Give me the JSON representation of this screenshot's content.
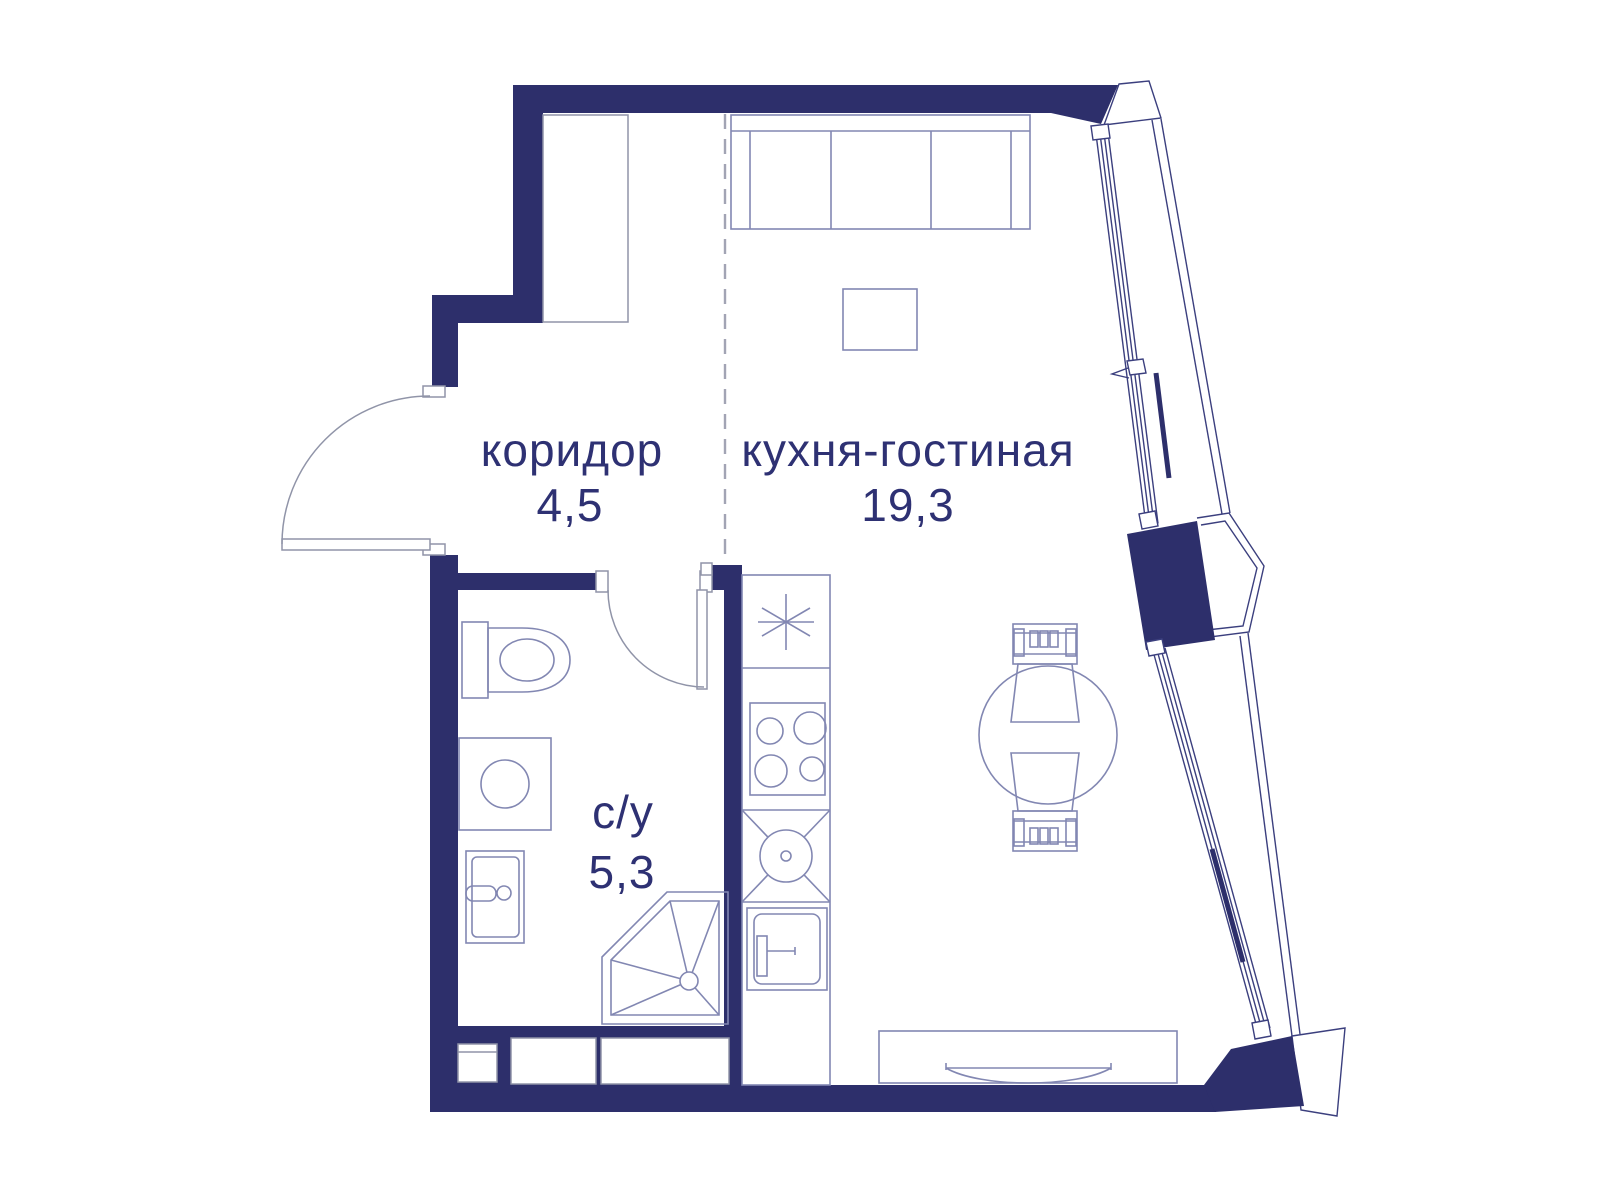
{
  "title": "Studio apartment floor plan",
  "rooms": [
    {
      "id": "corridor",
      "name": "коридор",
      "area": "4,5"
    },
    {
      "id": "kitchen-living",
      "name": "кухня-гостиная",
      "area": "19,3"
    },
    {
      "id": "bathroom",
      "name": "с/у",
      "area": "5,3"
    }
  ],
  "colors": {
    "wall": "#2d2f6b",
    "furniture_line": "#8287b2",
    "window_line": "#3b3f7e",
    "door_line": "#9094a8",
    "zoning_dash": "#a2a4b4",
    "text": "#2e3173"
  },
  "fixtures": [
    "wardrobe",
    "sofa",
    "coffee-table",
    "dining-table",
    "dining-chair-top",
    "dining-chair-bottom",
    "tv-stand",
    "fridge",
    "stove",
    "kitchen-sink-unit",
    "kitchen-sink",
    "shower",
    "toilet",
    "washing-machine",
    "wash-basin",
    "entrance-door",
    "bathroom-door",
    "panoramic-window",
    "bay-window",
    "wall-pier"
  ]
}
